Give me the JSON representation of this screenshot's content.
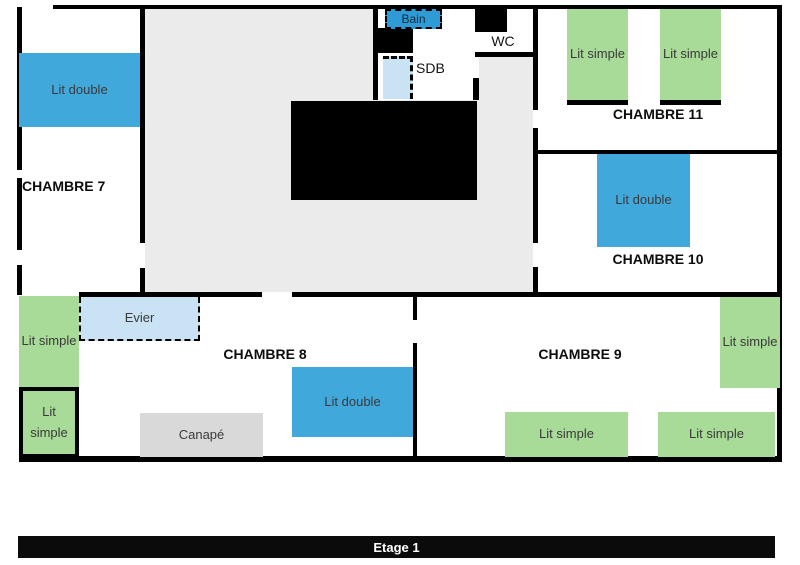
{
  "floor_label": "Etage 1",
  "labels": {
    "chambre7": "CHAMBRE 7",
    "chambre8": "CHAMBRE 8",
    "chambre9": "CHAMBRE 9",
    "chambre10": "CHAMBRE 10",
    "chambre11": "CHAMBRE 11",
    "sdb": "SDB",
    "wc": "WC",
    "bain": "Bain",
    "evier": "Evier",
    "canape": "Canapé",
    "lit_double": "Lit double",
    "lit_simple": "Lit simple"
  },
  "colors": {
    "bed_double": "#41a8dc",
    "bed_simple": "#a8da98",
    "fixture": "#c9e3f4",
    "hall": "#ebebeb",
    "sofa": "#d9d9d9",
    "wall": "#000000",
    "bain": "#2e9bd6"
  }
}
